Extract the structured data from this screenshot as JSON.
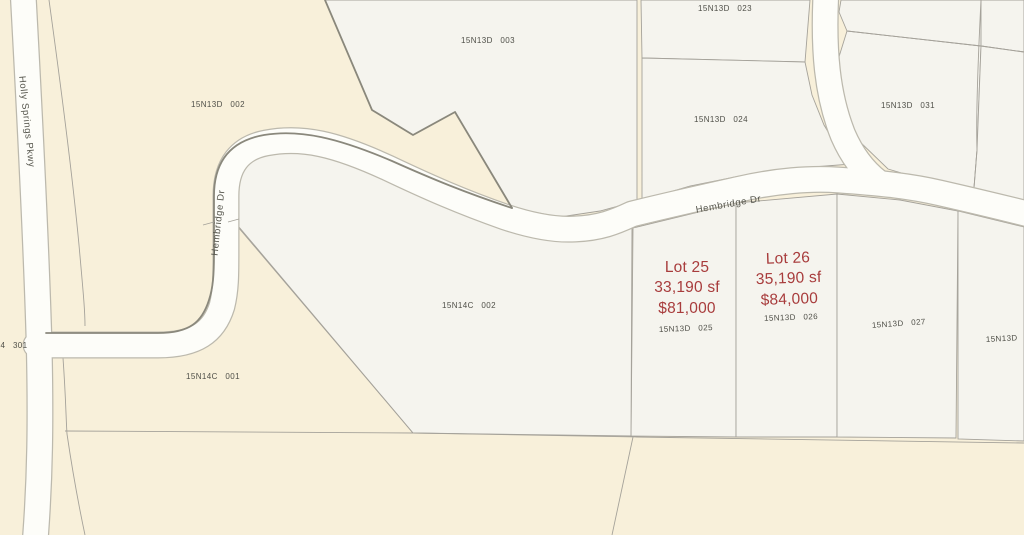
{
  "map": {
    "colors": {
      "background": "#f8f0da",
      "parcel_fill": "#f5f4ee",
      "road_fill": "#fdfdf9",
      "boundary": "#a5a29a",
      "highlight_boundary": "#8a887c",
      "parcel_label": "#4f4f48",
      "lot_label": "#a83c3c"
    },
    "streets": {
      "holly_springs": {
        "name": "Holly Springs Pkwy"
      },
      "hembridge_vertical": {
        "name": "Hembridge Dr"
      },
      "hembridge_main": {
        "name": "Hembridge Dr"
      }
    },
    "parcels": {
      "p002": {
        "id": "15N13D 002"
      },
      "p003": {
        "id": "15N13D 003"
      },
      "p023": {
        "id": "15N13D 023"
      },
      "p024": {
        "id": "15N13D 024"
      },
      "p031": {
        "id": "15N13D 031"
      },
      "p14c002": {
        "id": "15N14C 002"
      },
      "p14c001": {
        "id": "15N14C 001"
      },
      "p027": {
        "id": "15N13D 027"
      },
      "p_edge": {
        "id": "15N13D 0"
      }
    },
    "lots": [
      {
        "name": "Lot 25",
        "area": "33,190 sf",
        "price": "$81,000",
        "parcel_id": "15N13D 025"
      },
      {
        "name": "Lot 26",
        "area": "35,190 sf",
        "price": "$84,000",
        "parcel_id": "15N13D 026"
      }
    ],
    "annotations": {
      "left_parcel_number": "4 301"
    }
  }
}
